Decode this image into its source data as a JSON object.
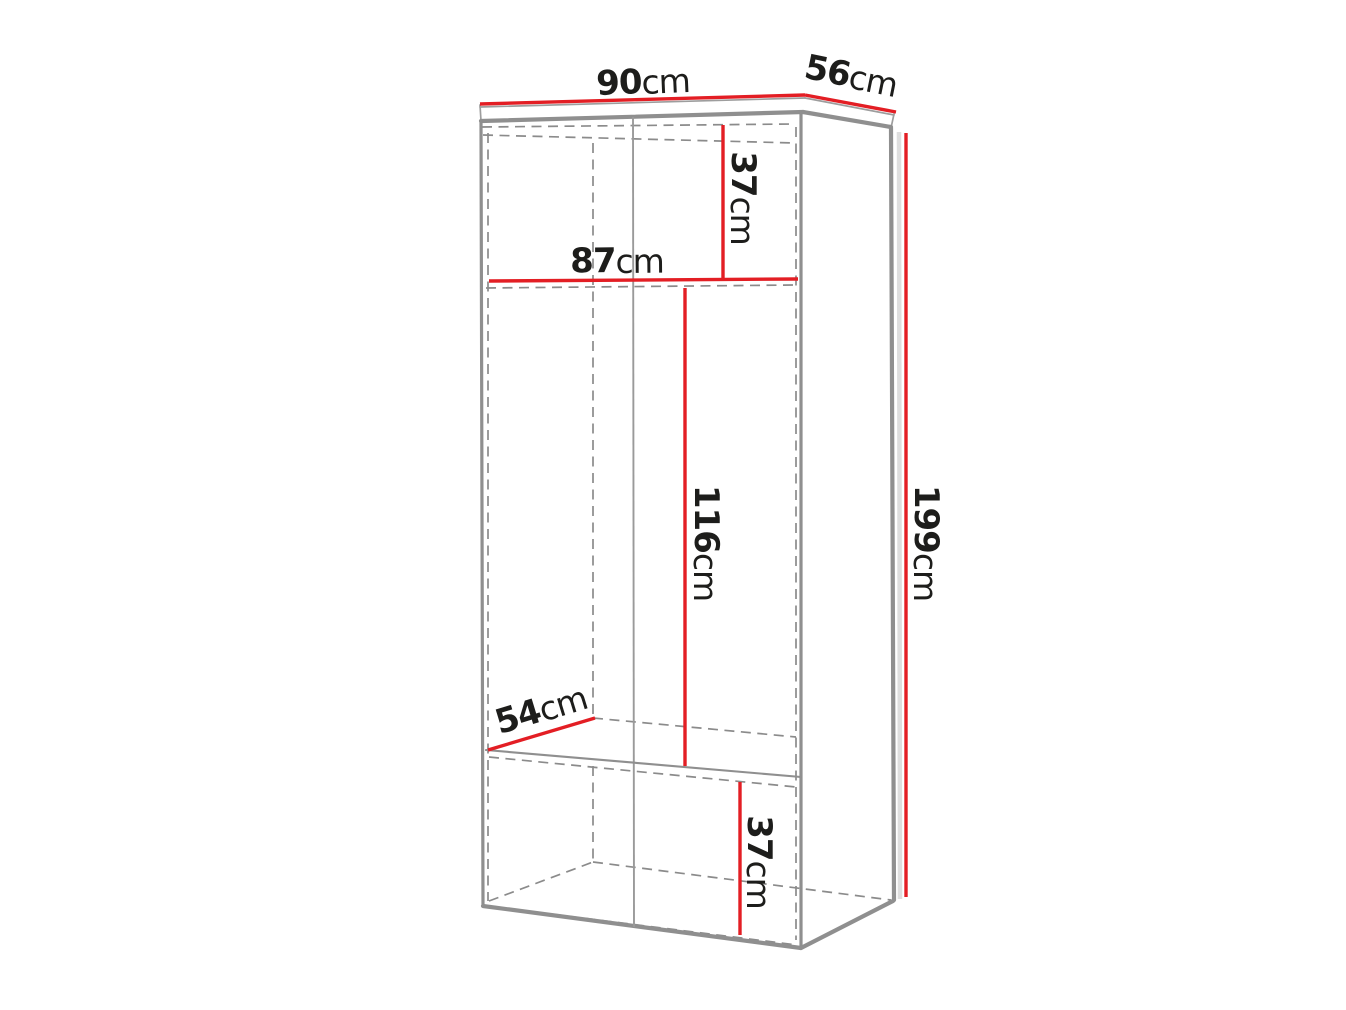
{
  "diagram": {
    "kind": "wardrobe-dimension-diagram",
    "colors": {
      "dimension_line_red": "#e31e24",
      "visible_edge_gray": "#8f8f8f",
      "hidden_edge_gray": "#8b8b8b",
      "label_text": "#1d1d1b",
      "background": "#ffffff"
    },
    "dimensions": {
      "top_width": {
        "value": "90",
        "unit": "cm"
      },
      "top_depth": {
        "value": "56",
        "unit": "cm"
      },
      "upper_compartment_height": {
        "value": "37",
        "unit": "cm"
      },
      "interior_width": {
        "value": "87",
        "unit": "cm"
      },
      "middle_compartment_height": {
        "value": "116",
        "unit": "cm"
      },
      "total_height": {
        "value": "199",
        "unit": "cm"
      },
      "shelf_depth": {
        "value": "54",
        "unit": "cm"
      },
      "bottom_compartment_height": {
        "value": "37",
        "unit": "cm"
      }
    }
  }
}
